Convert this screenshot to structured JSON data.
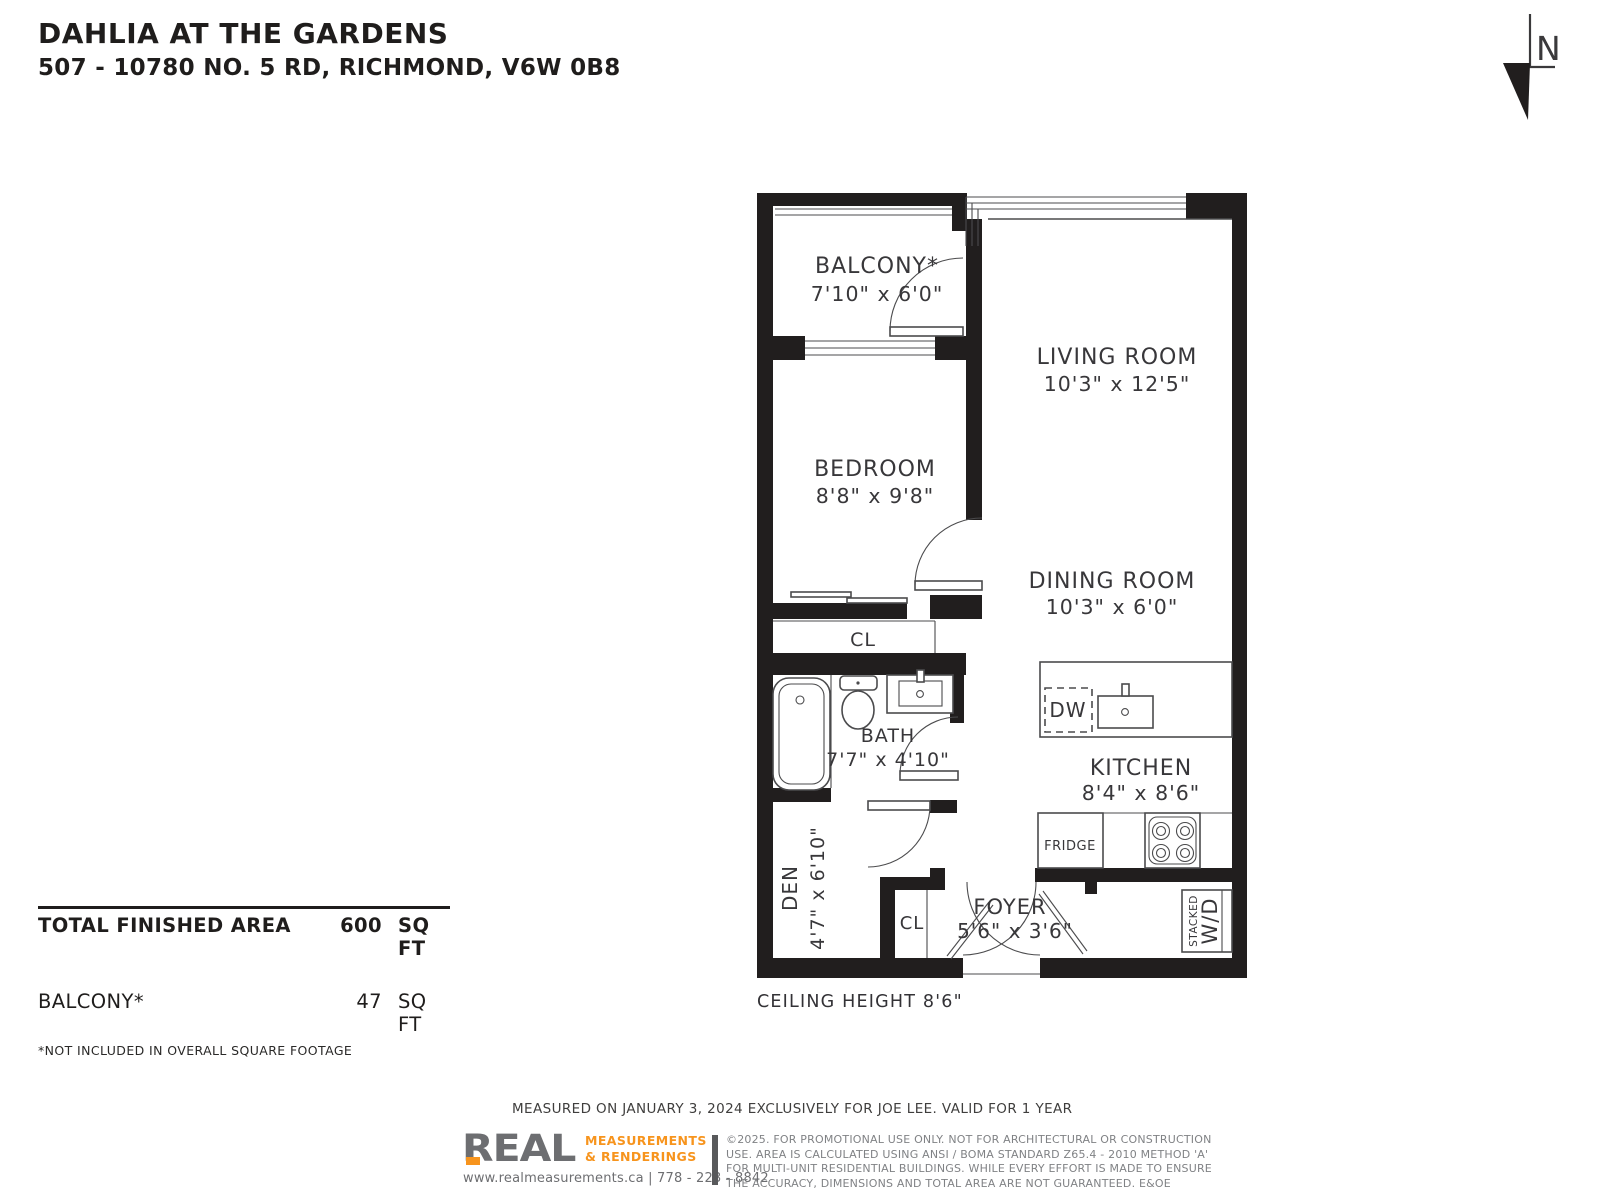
{
  "header": {
    "title": "DAHLIA AT THE GARDENS",
    "address": "507 - 10780 NO. 5 RD, RICHMOND, V6W 0B8"
  },
  "north_arrow": {
    "label": "N"
  },
  "plan": {
    "rooms": [
      {
        "name": "BALCONY*",
        "dims": "7'10\" x 6'0\""
      },
      {
        "name": "LIVING ROOM",
        "dims": "10'3\" x 12'5\""
      },
      {
        "name": "BEDROOM",
        "dims": "8'8\" x 9'8\""
      },
      {
        "name": "DINING ROOM",
        "dims": "10'3\" x 6'0\""
      },
      {
        "name": "BATH",
        "dims": "7'7\" x 4'10\""
      },
      {
        "name": "KITCHEN",
        "dims": "8'4\" x 8'6\""
      },
      {
        "name": "DEN",
        "dims": "4'7\" x 6'10\""
      },
      {
        "name": "FOYER",
        "dims": "5'6\" x 3'6\""
      }
    ],
    "labels": {
      "closet_bedroom": "CL",
      "closet_foyer": "CL",
      "dishwasher": "DW",
      "fridge": "FRIDGE",
      "stacked": "STACKED",
      "washer_dryer": "W/D"
    },
    "ceiling_height": "CEILING HEIGHT 8'6\""
  },
  "areas": {
    "total_label": "TOTAL FINISHED AREA",
    "total_value": "600",
    "total_unit": "SQ FT",
    "balcony_label": "BALCONY*",
    "balcony_value": "47",
    "balcony_unit": "SQ FT",
    "note": "*NOT INCLUDED IN OVERALL SQUARE FOOTAGE"
  },
  "footer": {
    "measured": "MEASURED ON JANUARY 3, 2024 EXCLUSIVELY FOR JOE LEE. VALID FOR 1 YEAR",
    "logo": {
      "name": "REAL",
      "tag1": "MEASUREMENTS",
      "tag2": "& RENDERINGS",
      "contact": "www.realmeasurements.ca | 778 - 223 - 8842"
    },
    "disclaimer": [
      "©2025. FOR PROMOTIONAL USE ONLY. NOT FOR ARCHITECTURAL OR CONSTRUCTION",
      "USE. AREA IS CALCULATED USING ANSI / BOMA STANDARD Z65.4 - 2010 METHOD 'A'",
      "FOR MULTI-UNIT RESIDENTIAL BUILDINGS. WHILE EVERY EFFORT IS MADE TO ENSURE",
      "THE ACCURACY, DIMENSIONS AND TOTAL AREA ARE NOT GUARANTEED. E&OE"
    ]
  },
  "colors": {
    "ink": "#211e1e",
    "line": "#4b4b4d",
    "accent_orange": "#f7941d",
    "logo_gray": "#6d6e71",
    "muted_gray": "#808285"
  }
}
